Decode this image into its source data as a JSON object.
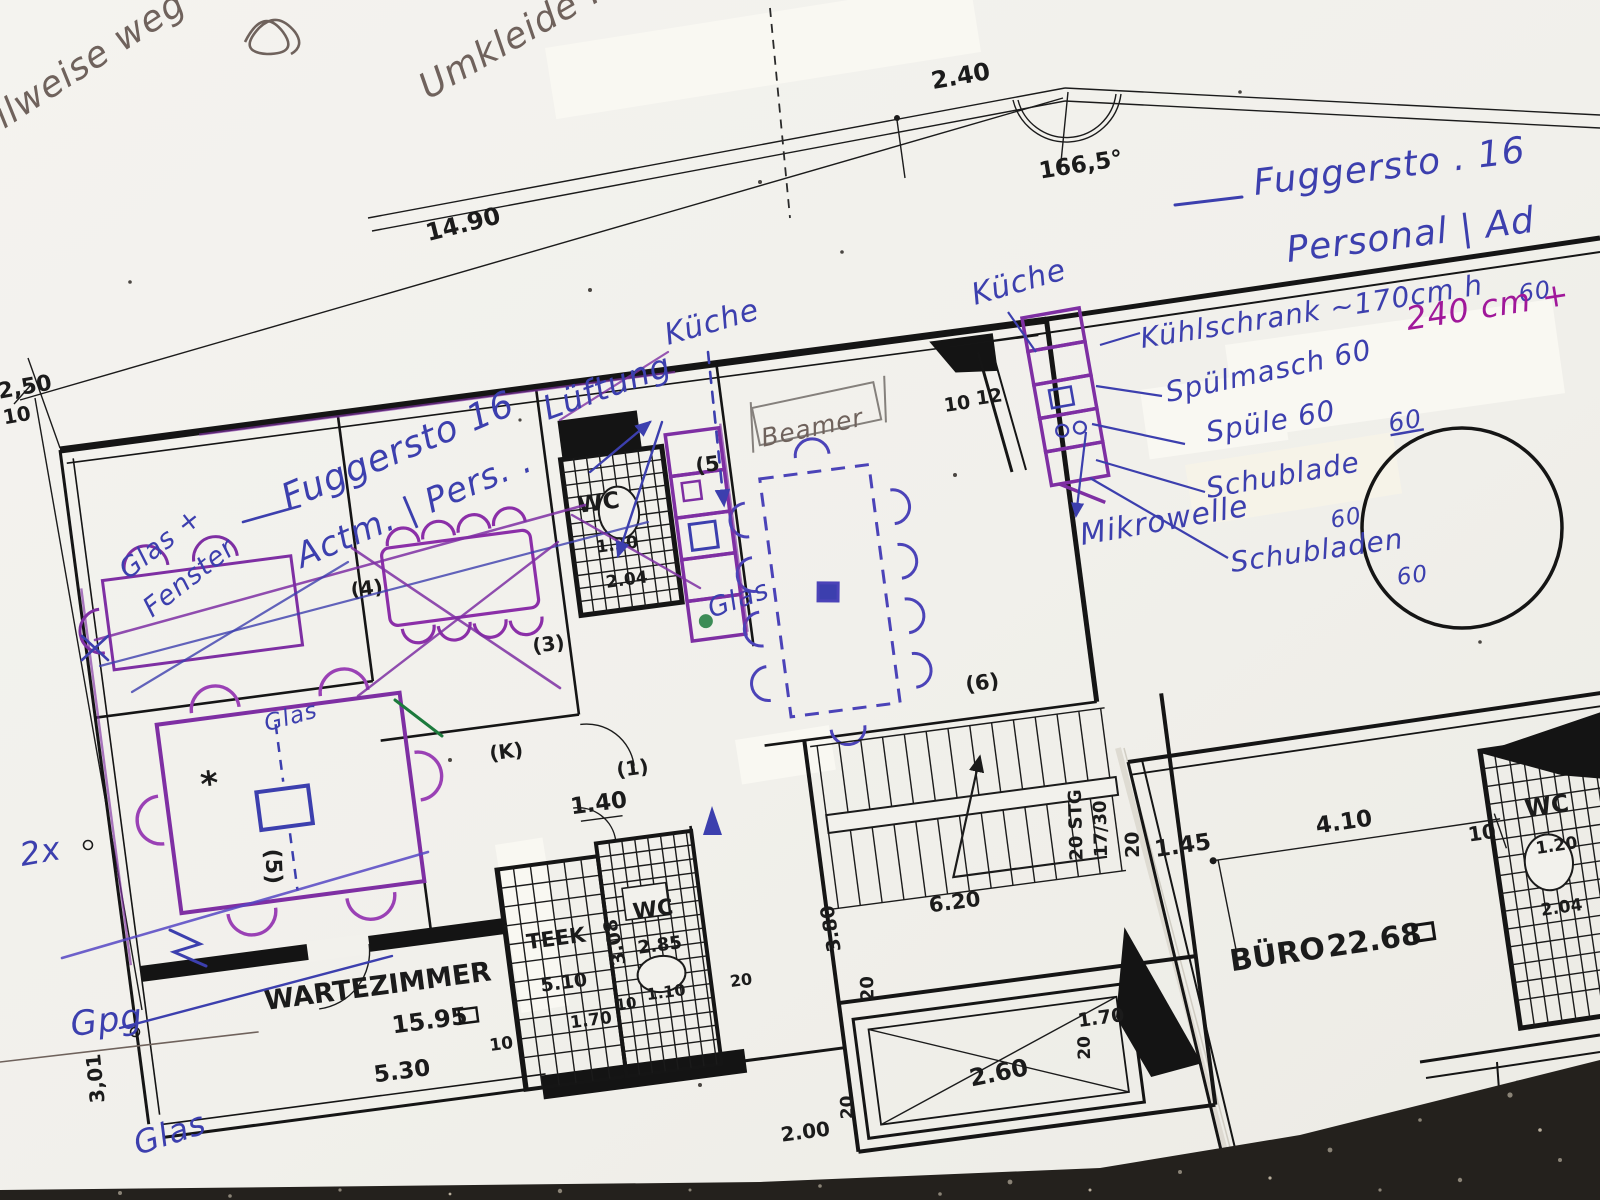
{
  "colors": {
    "ink_blue": "#3c3fae",
    "ink_purple": "#7e2fa3",
    "ink_magenta": "#a0189a",
    "ink_green": "#1c7a3c",
    "print_black": "#1a1a1a",
    "pencil_gray": "#6f625c",
    "paper": "#f2f1ec",
    "table_dark": "#23201c"
  },
  "handwriting": {
    "blue": {
      "title_line1": "Fuggersto . 16",
      "title_line2": "Personal | Ad",
      "kueche_right": "Küche",
      "kuehlschrank": "Kühlschrank ~170cm h",
      "kuehlschrank_60": "60",
      "spuelmasch": "Spülmasch 60",
      "spuele": "Spüle 60",
      "spuele_60": "60",
      "schublade": "Schublade",
      "schublade_60": "60",
      "schubladen": "Schubladen",
      "schubladen_60": "60",
      "mikrowelle": "Mikrowelle",
      "kueche_mid": "Küche",
      "fuggersto_mid": "Fuggersto 16",
      "lueftung": "Lüftung",
      "actm_pers": "Actm. | Pers. .",
      "glas_fenster_1": "Glas +",
      "glas_fenster_2": "Fenster",
      "glas_beamer_room": "Glas",
      "glas_table_room": "Glas",
      "two_x": "2x",
      "gpg": "Gpg",
      "glas_bottom": "Glas"
    },
    "magenta": {
      "cm_240": "240 cm +"
    },
    "pencil": {
      "teilweise_weg": "teilweise weg",
      "umkleide": "Umkleide :",
      "beamer": "Beamer"
    }
  },
  "printed": {
    "rooms": {
      "wartezimmer": "WARTEZIMMER",
      "wartezimmer_area": "15.95",
      "teek": "TEEK",
      "teek_dim": "5.10",
      "wc_top": "WC",
      "wc_bottom": "WC",
      "wc_right": "WC",
      "buero": "BÜRO",
      "buero_area": "22.68"
    },
    "dims": {
      "d2_40": "2.40",
      "angle": "166,5°",
      "d14_90": "14.90",
      "d2_50": "2,50",
      "d10_left": "10",
      "d10_top": "10",
      "d12_top": "12",
      "wc_top_w": "1.20",
      "wc_top_l": "2.04",
      "d1_40": "1.40",
      "d5_30": "5.30",
      "d3_01": "3,01",
      "d3_08": "3.08",
      "d1_70_teek": "1.70",
      "d10_teek": "10",
      "d10_wc": "10",
      "d1_10": "1.10",
      "d20_wc": "20",
      "d2_85": "2.85",
      "d3_80": "3.80",
      "stg": "20 STG",
      "stg_ratio": "17/30",
      "d6_20": "6.20",
      "d20_stair": "20",
      "d20_stair2": "20",
      "d2_60": "2.60",
      "d2_00": "2.00",
      "d20_elev": "20",
      "d20_elev2": "20",
      "d1_45": "1.45",
      "d4_10": "4.10",
      "d10_buero": "10",
      "wc_r_w": "1.20",
      "wc_r_l": "2.04",
      "d1_70_elev": "1.70"
    },
    "marks": {
      "p1": "(1)",
      "p3": "(3)",
      "p4": "(4)",
      "p5_top": "(5",
      "p5_table": "(5)",
      "p6": "(6)",
      "pk": "(K)"
    }
  }
}
